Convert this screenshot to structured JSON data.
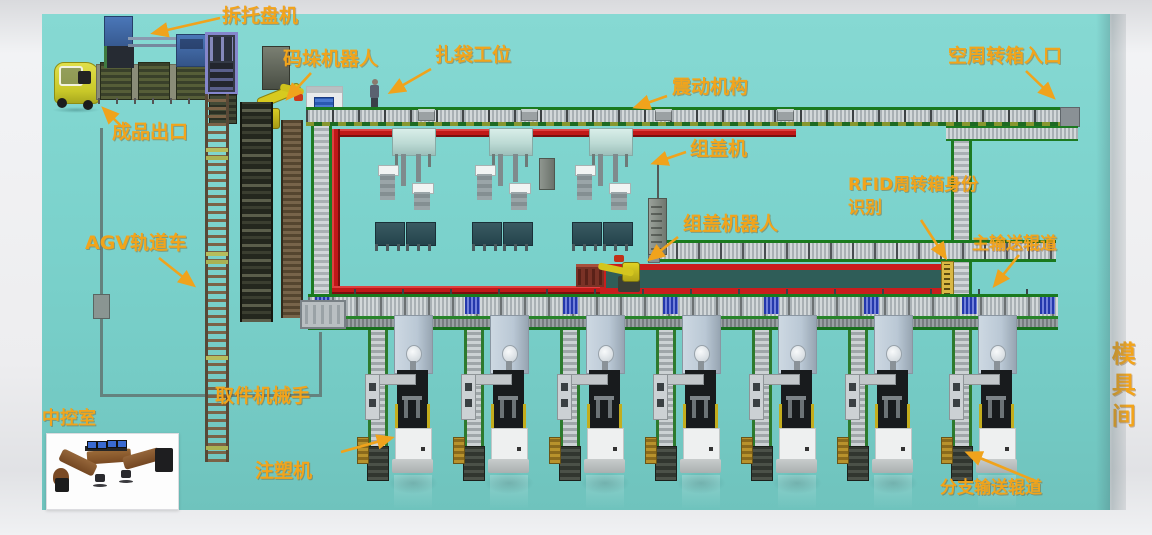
{
  "scene_labels": [
    {
      "id": "label-depalletizer",
      "text": "拆托盘机",
      "x": 222,
      "y": 7,
      "size": 19
    },
    {
      "id": "label-palletizing-robot",
      "text": "码垛机器人",
      "x": 283,
      "y": 50,
      "size": 19
    },
    {
      "id": "label-bagging-station",
      "text": "扎袋工位",
      "x": 435,
      "y": 46,
      "size": 19
    },
    {
      "id": "label-vibration-mechanism",
      "text": "震动机构",
      "x": 672,
      "y": 78,
      "size": 19
    },
    {
      "id": "label-empty-tote-entrance",
      "text": "空周转箱入口",
      "x": 948,
      "y": 47,
      "size": 19
    },
    {
      "id": "label-finished-product-exit",
      "text": "成品出口",
      "x": 112,
      "y": 123,
      "size": 19
    },
    {
      "id": "label-cap-assembly-machine",
      "text": "组盖机",
      "x": 690,
      "y": 140,
      "size": 19
    },
    {
      "id": "label-rfid-identification-line1",
      "text": "RFID周转箱身份",
      "x": 848,
      "y": 177,
      "size": 17
    },
    {
      "id": "label-rfid-identification-line2",
      "text": "识别",
      "x": 848,
      "y": 200,
      "size": 17
    },
    {
      "id": "label-cap-assembly-robot",
      "text": "组盖机器人",
      "x": 683,
      "y": 215,
      "size": 19
    },
    {
      "id": "label-main-conveyor",
      "text": "主输送辊道",
      "x": 972,
      "y": 236,
      "size": 17
    },
    {
      "id": "label-agv-rail-car",
      "text": "AGV轨道车",
      "x": 85,
      "y": 234,
      "size": 19
    },
    {
      "id": "label-picker-robot-arm",
      "text": "取件机械手",
      "x": 215,
      "y": 387,
      "size": 19
    },
    {
      "id": "label-control-room",
      "text": "中控室",
      "x": 42,
      "y": 410,
      "size": 18
    },
    {
      "id": "label-injection-molding-machine",
      "text": "注塑机",
      "x": 255,
      "y": 462,
      "size": 19
    },
    {
      "id": "label-branch-conveyor",
      "text": "分支输送辊道",
      "x": 940,
      "y": 480,
      "size": 17
    },
    {
      "id": "label-mold-room",
      "text": "模具间",
      "x": 1108,
      "y": 341,
      "size": 24,
      "vertical": true
    }
  ],
  "annotation_arrows": [
    {
      "name": "arrow-depalletizer",
      "x1": 220,
      "y1": 18,
      "x2": 154,
      "y2": 33
    },
    {
      "name": "arrow-palletizing-robot",
      "x1": 311,
      "y1": 73,
      "x2": 288,
      "y2": 98
    },
    {
      "name": "arrow-bagging-station",
      "x1": 431,
      "y1": 69,
      "x2": 391,
      "y2": 92
    },
    {
      "name": "arrow-vibration-mechanism",
      "x1": 667,
      "y1": 96,
      "x2": 636,
      "y2": 107
    },
    {
      "name": "arrow-empty-tote-entrance",
      "x1": 1026,
      "y1": 71,
      "x2": 1053,
      "y2": 97
    },
    {
      "name": "arrow-finished-product-exit",
      "x1": 121,
      "y1": 126,
      "x2": 104,
      "y2": 109
    },
    {
      "name": "arrow-cap-assembly-machine",
      "x1": 686,
      "y1": 152,
      "x2": 654,
      "y2": 163
    },
    {
      "name": "arrow-rfid",
      "x1": 921,
      "y1": 220,
      "x2": 945,
      "y2": 257
    },
    {
      "name": "arrow-cap-assembly-robot",
      "x1": 678,
      "y1": 237,
      "x2": 650,
      "y2": 259
    },
    {
      "name": "arrow-main-conveyor",
      "x1": 1019,
      "y1": 255,
      "x2": 995,
      "y2": 285
    },
    {
      "name": "arrow-agv-rail-car",
      "x1": 159,
      "y1": 258,
      "x2": 193,
      "y2": 285
    },
    {
      "name": "arrow-injection-molding-machine",
      "x1": 341,
      "y1": 452,
      "x2": 391,
      "y2": 438
    },
    {
      "name": "arrow-branch-conveyor",
      "x1": 1038,
      "y1": 482,
      "x2": 968,
      "y2": 453
    }
  ],
  "equipment": {
    "injection_molding_units": {
      "count": 7,
      "x": [
        368,
        464,
        560,
        656,
        752,
        848,
        952
      ]
    },
    "cap_assembly_stations": {
      "count": 3,
      "x": [
        392,
        489,
        589
      ]
    },
    "main_conveyor_blue_sections_x": [
      315,
      465,
      563,
      663,
      764,
      864,
      962,
      1040
    ],
    "top_conveyor_crates_x": [
      418,
      521,
      655,
      777
    ]
  },
  "colors": {
    "floor_teal": "#7bd2cc",
    "label_orange": "#f2a41b",
    "conveyor_green": "#1a7a1e",
    "red_rail": "#c41c1c",
    "robot_yellow": "#d7ca1f"
  }
}
